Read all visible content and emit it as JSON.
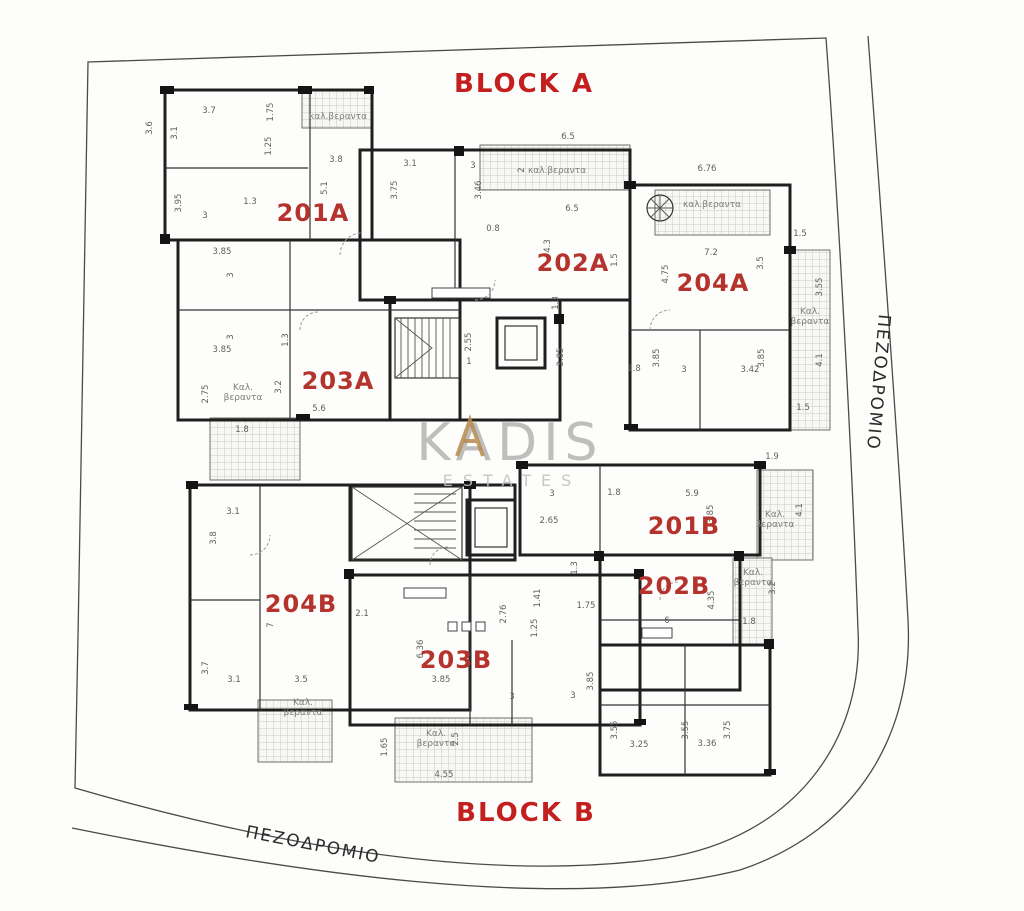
{
  "blocks": {
    "a": "BLOCK A",
    "b": "BLOCK B"
  },
  "watermark": {
    "brand": "KADIS",
    "tagline": "ESTATES",
    "gray": "#a9a9a9",
    "gold": "#b5894c"
  },
  "streets": [
    {
      "text": "ΠΕΖΟΔΡΟΜΙΟ",
      "x": 873,
      "y": 382,
      "rotate": 95
    },
    {
      "text": "ΠΕΖΟΔΡΟΜΙΟ",
      "x": 312,
      "y": 850,
      "rotate": 11
    }
  ],
  "apartments": [
    {
      "id": "201A",
      "x": 313,
      "y": 221
    },
    {
      "id": "202A",
      "x": 573,
      "y": 271
    },
    {
      "id": "204A",
      "x": 713,
      "y": 291
    },
    {
      "id": "203A",
      "x": 338,
      "y": 389
    },
    {
      "id": "201B",
      "x": 684,
      "y": 534
    },
    {
      "id": "202B",
      "x": 674,
      "y": 594
    },
    {
      "id": "204B",
      "x": 301,
      "y": 612
    },
    {
      "id": "203B",
      "x": 456,
      "y": 668
    }
  ],
  "veranda_labels": [
    {
      "lines": [
        "καλ.βεραντα"
      ],
      "x": 338,
      "y": 119
    },
    {
      "lines": [
        "καλ.βεραντα"
      ],
      "x": 557,
      "y": 173
    },
    {
      "lines": [
        "καλ.βεραντα"
      ],
      "x": 712,
      "y": 207
    },
    {
      "lines": [
        "Καλ.",
        "βεραντα"
      ],
      "x": 810,
      "y": 314
    },
    {
      "lines": [
        "Καλ.",
        "βεραντα"
      ],
      "x": 243,
      "y": 390
    },
    {
      "lines": [
        "Καλ.",
        "βεραντα"
      ],
      "x": 775,
      "y": 517
    },
    {
      "lines": [
        "Καλ.",
        "βεραντα"
      ],
      "x": 753,
      "y": 575
    },
    {
      "lines": [
        "Καλ.",
        "βεραντα"
      ],
      "x": 303,
      "y": 705
    },
    {
      "lines": [
        "Καλ.",
        "βεραντα"
      ],
      "x": 436,
      "y": 736
    }
  ],
  "dimensions": [
    {
      "t": "3.6",
      "x": 152,
      "y": 128,
      "v": true
    },
    {
      "t": "3.7",
      "x": 209,
      "y": 113
    },
    {
      "t": "3.1",
      "x": 177,
      "y": 133,
      "v": true
    },
    {
      "t": "1.75",
      "x": 273,
      "y": 112,
      "v": true
    },
    {
      "t": "1.25",
      "x": 271,
      "y": 146,
      "v": true
    },
    {
      "t": "3.8",
      "x": 336,
      "y": 162
    },
    {
      "t": "5.1",
      "x": 327,
      "y": 188,
      "v": true
    },
    {
      "t": "3.95",
      "x": 181,
      "y": 203,
      "v": true
    },
    {
      "t": "3",
      "x": 205,
      "y": 218
    },
    {
      "t": "1.3",
      "x": 250,
      "y": 204
    },
    {
      "t": "3.85",
      "x": 222,
      "y": 254
    },
    {
      "t": "3",
      "x": 233,
      "y": 275,
      "v": true
    },
    {
      "t": "3.85",
      "x": 222,
      "y": 352
    },
    {
      "t": "3",
      "x": 233,
      "y": 337,
      "v": true
    },
    {
      "t": "1.3",
      "x": 288,
      "y": 340,
      "v": true
    },
    {
      "t": "3.2",
      "x": 281,
      "y": 387,
      "v": true
    },
    {
      "t": "5.6",
      "x": 319,
      "y": 411
    },
    {
      "t": "2.75",
      "x": 208,
      "y": 394,
      "v": true
    },
    {
      "t": "1.8",
      "x": 242,
      "y": 432
    },
    {
      "t": "2.55",
      "x": 471,
      "y": 342,
      "v": true
    },
    {
      "t": "1",
      "x": 469,
      "y": 364
    },
    {
      "t": "3.1",
      "x": 410,
      "y": 166
    },
    {
      "t": "3.75",
      "x": 397,
      "y": 190,
      "v": true
    },
    {
      "t": "3",
      "x": 473,
      "y": 168
    },
    {
      "t": "3.46",
      "x": 481,
      "y": 190,
      "v": true
    },
    {
      "t": "6.5",
      "x": 568,
      "y": 139
    },
    {
      "t": "2",
      "x": 524,
      "y": 170,
      "v": true
    },
    {
      "t": "6.5",
      "x": 572,
      "y": 211
    },
    {
      "t": "4.3",
      "x": 550,
      "y": 246,
      "v": true
    },
    {
      "t": "0.8",
      "x": 493,
      "y": 231
    },
    {
      "t": "1.5",
      "x": 617,
      "y": 260,
      "v": true
    },
    {
      "t": "1.3",
      "x": 558,
      "y": 303,
      "v": true
    },
    {
      "t": "6.76",
      "x": 707,
      "y": 171
    },
    {
      "t": "7.2",
      "x": 711,
      "y": 255
    },
    {
      "t": "4.75",
      "x": 668,
      "y": 274,
      "v": true
    },
    {
      "t": "3.5",
      "x": 763,
      "y": 263,
      "v": true
    },
    {
      "t": "1.5",
      "x": 800,
      "y": 236
    },
    {
      "t": "3.55",
      "x": 822,
      "y": 287,
      "v": true
    },
    {
      "t": "3.85",
      "x": 563,
      "y": 357,
      "v": true
    },
    {
      "t": "3.85",
      "x": 659,
      "y": 358,
      "v": true
    },
    {
      "t": "3.85",
      "x": 764,
      "y": 358,
      "v": true
    },
    {
      "t": "3",
      "x": 684,
      "y": 372
    },
    {
      "t": "3.42",
      "x": 750,
      "y": 372
    },
    {
      "t": "1.8",
      "x": 634,
      "y": 371
    },
    {
      "t": "4.1",
      "x": 822,
      "y": 360,
      "v": true
    },
    {
      "t": "1.5",
      "x": 803,
      "y": 410
    },
    {
      "t": "1.9",
      "x": 772,
      "y": 459
    },
    {
      "t": "3",
      "x": 552,
      "y": 496
    },
    {
      "t": "1.8",
      "x": 614,
      "y": 495
    },
    {
      "t": "5.9",
      "x": 692,
      "y": 496
    },
    {
      "t": "2.65",
      "x": 549,
      "y": 523
    },
    {
      "t": "3.85",
      "x": 713,
      "y": 514,
      "v": true
    },
    {
      "t": "4.1",
      "x": 802,
      "y": 510,
      "v": true
    },
    {
      "t": "1.3",
      "x": 577,
      "y": 568,
      "v": true
    },
    {
      "t": "3.2",
      "x": 775,
      "y": 588,
      "v": true
    },
    {
      "t": "4.35",
      "x": 714,
      "y": 600,
      "v": true
    },
    {
      "t": "6",
      "x": 667,
      "y": 623
    },
    {
      "t": "1.8",
      "x": 749,
      "y": 624
    },
    {
      "t": "1.41",
      "x": 540,
      "y": 598,
      "v": true
    },
    {
      "t": "1.75",
      "x": 586,
      "y": 608
    },
    {
      "t": "1.25",
      "x": 537,
      "y": 628,
      "v": true
    },
    {
      "t": "3.1",
      "x": 233,
      "y": 514
    },
    {
      "t": "3.8",
      "x": 216,
      "y": 538,
      "v": true
    },
    {
      "t": "7",
      "x": 273,
      "y": 625,
      "v": true
    },
    {
      "t": "2.1",
      "x": 362,
      "y": 616
    },
    {
      "t": "6.36",
      "x": 423,
      "y": 649,
      "v": true
    },
    {
      "t": "2.76",
      "x": 506,
      "y": 614,
      "v": true
    },
    {
      "t": "3.7",
      "x": 208,
      "y": 668,
      "v": true
    },
    {
      "t": "3.1",
      "x": 234,
      "y": 682
    },
    {
      "t": "3.5",
      "x": 301,
      "y": 682
    },
    {
      "t": "3.85",
      "x": 441,
      "y": 682
    },
    {
      "t": "3",
      "x": 512,
      "y": 699
    },
    {
      "t": "3",
      "x": 573,
      "y": 698
    },
    {
      "t": "3.85",
      "x": 593,
      "y": 681,
      "v": true
    },
    {
      "t": "2.5",
      "x": 458,
      "y": 739,
      "v": true
    },
    {
      "t": "1.65",
      "x": 387,
      "y": 747,
      "v": true
    },
    {
      "t": "4.55",
      "x": 444,
      "y": 777
    },
    {
      "t": "3.55",
      "x": 617,
      "y": 730,
      "v": true
    },
    {
      "t": "3.25",
      "x": 639,
      "y": 747
    },
    {
      "t": "3.55",
      "x": 688,
      "y": 730,
      "v": true
    },
    {
      "t": "3.36",
      "x": 707,
      "y": 746
    },
    {
      "t": "3.75",
      "x": 730,
      "y": 730,
      "v": true
    }
  ],
  "colors": {
    "title_red": "#c41f1f",
    "apartment_red": "#b5332d",
    "wall": "#1f1f1f",
    "dim_text": "#5f5f5f",
    "boundary": "#4a4a4a",
    "watermark_gray": "#a9a9a9",
    "watermark_gold": "#b5894c",
    "background": "#fdfdfb"
  }
}
